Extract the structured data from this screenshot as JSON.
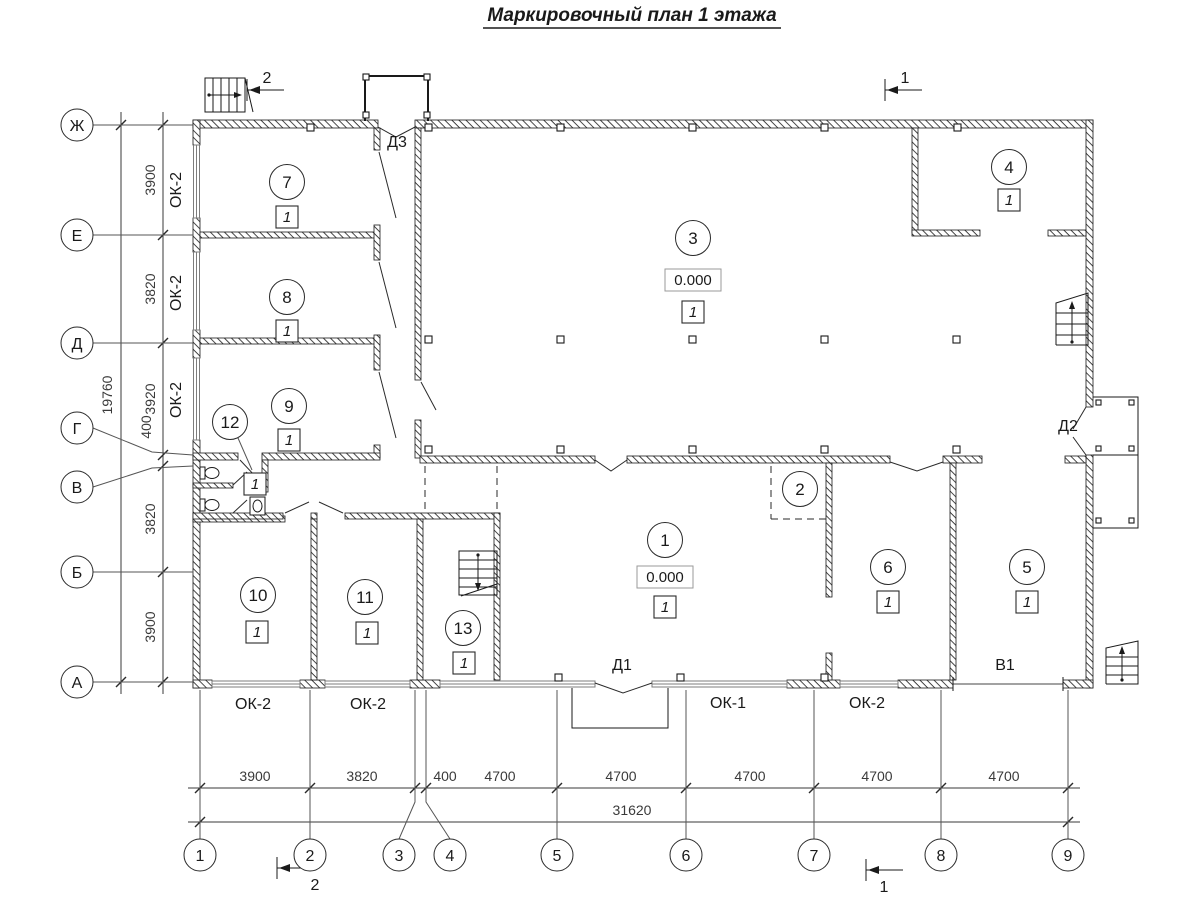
{
  "title": "Маркировочный план 1 этажа",
  "axes": {
    "bottom": [
      {
        "label": "1"
      },
      {
        "label": "2"
      },
      {
        "label": "3"
      },
      {
        "label": "4"
      },
      {
        "label": "5"
      },
      {
        "label": "6"
      },
      {
        "label": "7"
      },
      {
        "label": "8"
      },
      {
        "label": "9"
      }
    ],
    "left": [
      {
        "label": "Ж"
      },
      {
        "label": "Е"
      },
      {
        "label": "Д"
      },
      {
        "label": "Г"
      },
      {
        "label": "В"
      },
      {
        "label": "Б"
      },
      {
        "label": "А"
      }
    ]
  },
  "dims": {
    "bottom": [
      "3900",
      "3820",
      "400",
      "4700",
      "4700",
      "4700",
      "4700",
      "4700"
    ],
    "bottom_total": "31620",
    "left": [
      "3900",
      "3820",
      "3920",
      "400",
      "3820",
      "3900"
    ],
    "left_total": "19760"
  },
  "sections": {
    "one": "1",
    "two": "2"
  },
  "rooms": {
    "r1": {
      "num": "1",
      "elev": "0.000",
      "fin": "1"
    },
    "r2": {
      "num": "2"
    },
    "r3": {
      "num": "3",
      "elev": "0.000",
      "fin": "1"
    },
    "r4": {
      "num": "4",
      "fin": "1"
    },
    "r5": {
      "num": "5",
      "fin": "1"
    },
    "r6": {
      "num": "6",
      "fin": "1"
    },
    "r7": {
      "num": "7",
      "fin": "1"
    },
    "r8": {
      "num": "8",
      "fin": "1"
    },
    "r9": {
      "num": "9",
      "fin": "1"
    },
    "r10": {
      "num": "10",
      "fin": "1"
    },
    "r11": {
      "num": "11",
      "fin": "1"
    },
    "r12": {
      "num": "12",
      "fin": "1"
    },
    "r13": {
      "num": "13",
      "fin": "1"
    }
  },
  "doors": {
    "d1": "Д1",
    "d2": "Д2",
    "d3": "Д3"
  },
  "gate": {
    "v1": "В1"
  },
  "windows": {
    "left": [
      "ОК-2",
      "ОК-2",
      "ОК-2"
    ],
    "bottom": [
      "ОК-2",
      "ОК-2",
      "ОК-1",
      "ОК-2"
    ]
  }
}
